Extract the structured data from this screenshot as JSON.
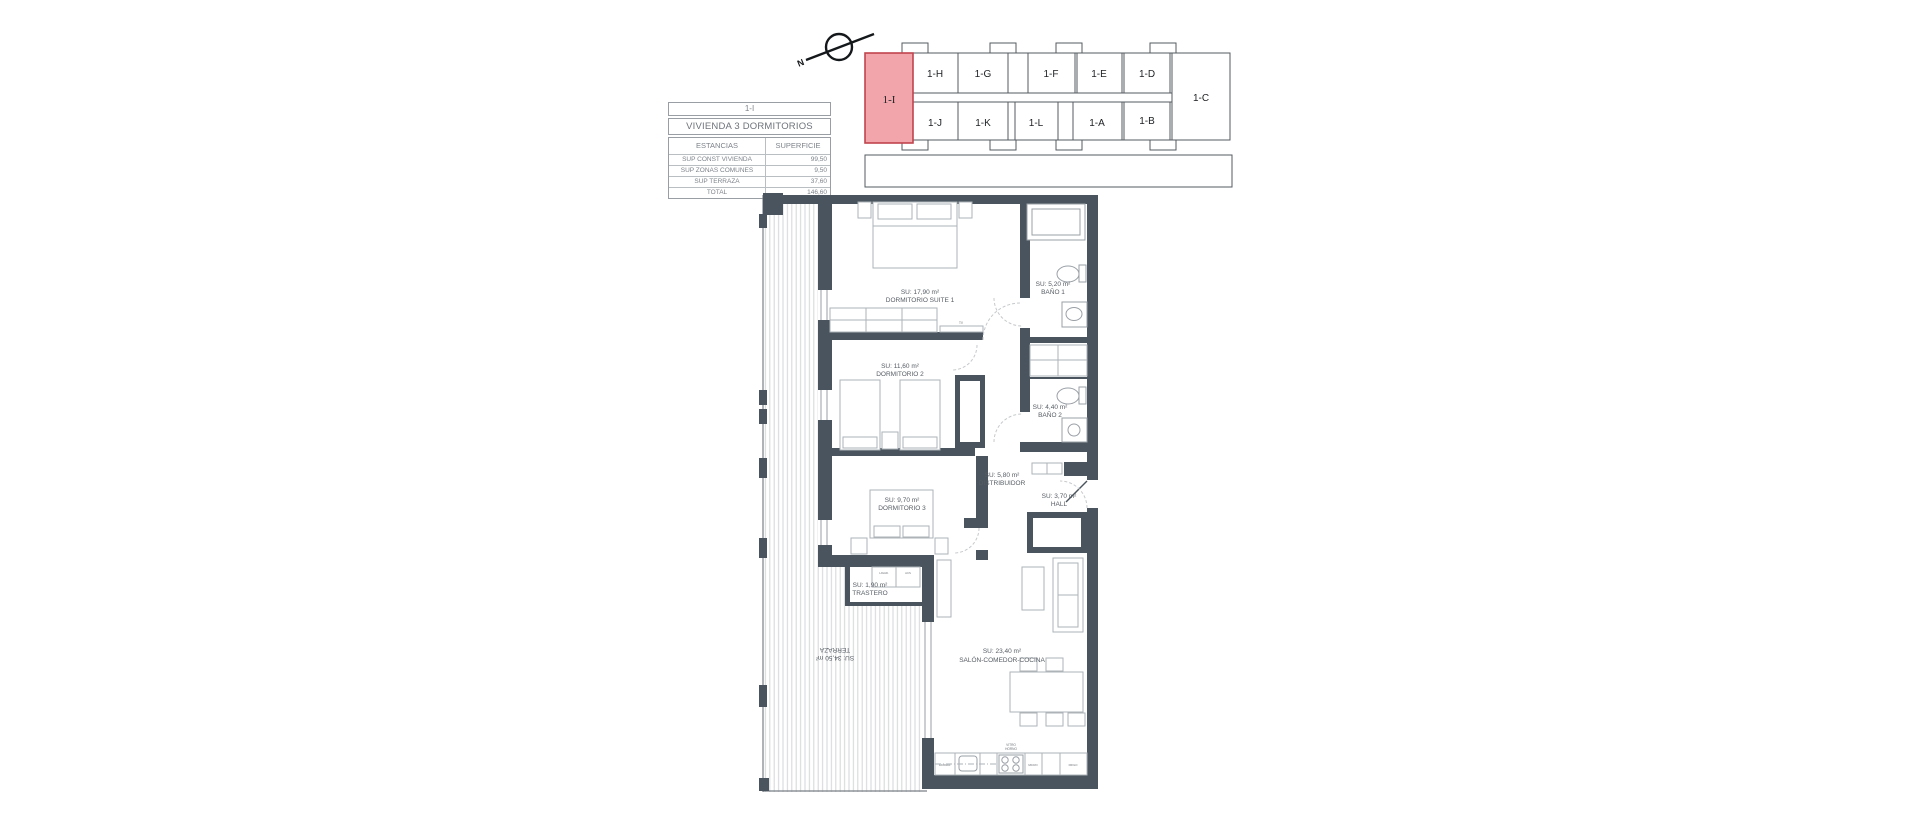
{
  "colors": {
    "wall": "#4A545E",
    "highlight_fill": "#F2A6AB",
    "highlight_stroke": "#C0444E",
    "hatch": "#d2d5d7",
    "table_text": "#7d838a"
  },
  "summary_table": {
    "unit": "1-I",
    "title": "VIVIENDA 3 DORMITORIOS",
    "col_estancias": "ESTANCIAS",
    "col_superficie": "SUPERFICIE",
    "rows": [
      {
        "label": "SUP CONST VIVIENDA",
        "value": "99,50"
      },
      {
        "label": "SUP ZONAS COMUNES",
        "value": "9,50"
      },
      {
        "label": "SUP TERRAZA",
        "value": "37,60"
      },
      {
        "label": "TOTAL",
        "value": "146,60"
      }
    ]
  },
  "key_plan": {
    "compass_label": "N",
    "highlight_unit": "1-I",
    "top_units": [
      "1-H",
      "1-G",
      "1-F",
      "1-E",
      "1-D"
    ],
    "right_unit": "1-C",
    "bottom_units": [
      "1-J",
      "1-K",
      "1-L",
      "1-A",
      "1-B"
    ]
  },
  "floor_plan": {
    "rooms": [
      {
        "area": "SU: 17,90 m²",
        "name": "DORMITORIO SUITE 1"
      },
      {
        "area": "SU: 5,20 m²",
        "name": "BAÑO 1"
      },
      {
        "area": "SU: 11,60 m²",
        "name": "DORMITORIO 2"
      },
      {
        "area": "SU: 4,40 m²",
        "name": "BAÑO 2"
      },
      {
        "area": "SU: 5,80 m²",
        "name": "DISTRIBUIDOR"
      },
      {
        "area": "SU: 3,70 m²",
        "name": "HALL"
      },
      {
        "area": "SU: 9,70 m²",
        "name": "DORMITORIO 3"
      },
      {
        "area": "SU: 1,90 m²",
        "name": "TRASTERO"
      },
      {
        "area": "SU: 34,50 m²",
        "name": "TERRAZA"
      },
      {
        "area": "SU: 23,40 m²",
        "name": "SALÓN-COMEDOR-COCINA"
      }
    ],
    "annotations": {
      "tv": "TV",
      "lavad": "LAVAD.",
      "acs": "ACS",
      "lavavaj": "LAVAVAJ.",
      "vitro": "VITRO",
      "horno": "HORNO",
      "micro": "MICRO",
      "frigo": "FRIGO"
    }
  }
}
